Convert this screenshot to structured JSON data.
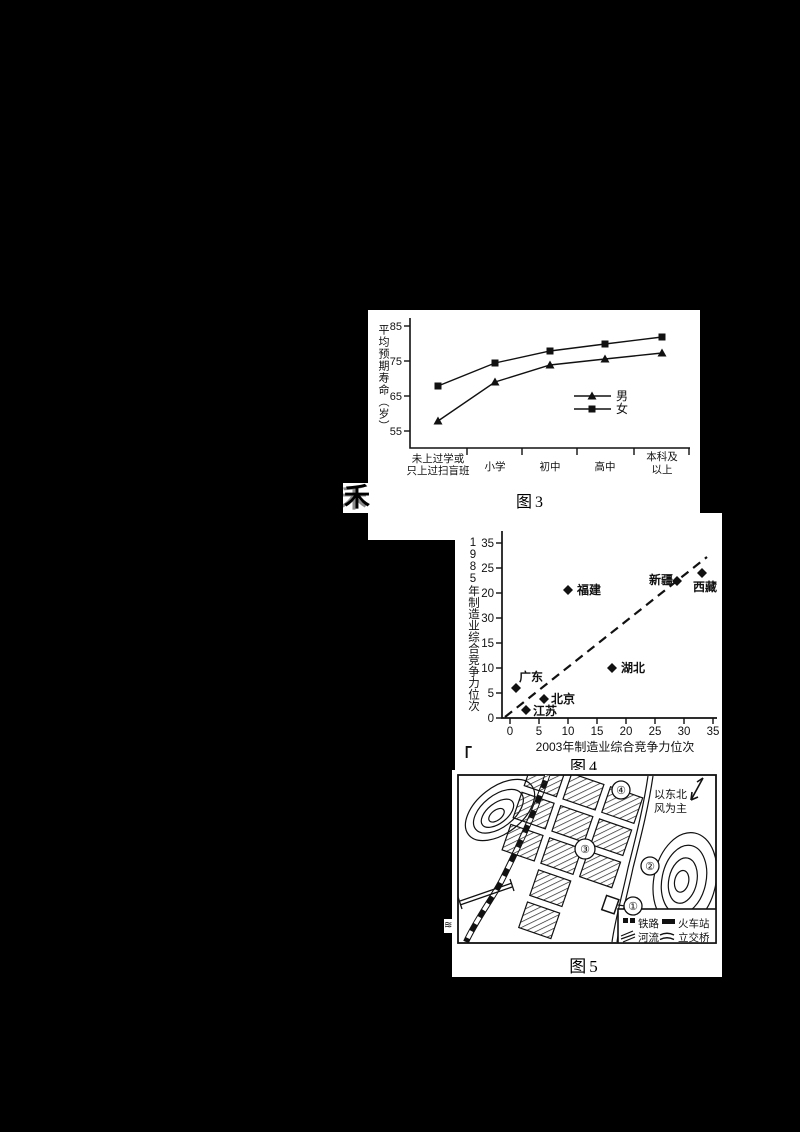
{
  "colors": {
    "page_bg": "#000000",
    "panel_bg": "#ffffff",
    "ink": "#111111"
  },
  "stray_marks": {
    "cut_character": "禾",
    "corner_bracket": "「",
    "edge_squiggle": "≋"
  },
  "chart_data": [
    {
      "id": "figure3",
      "type": "line",
      "title": "图3",
      "xlabel": "",
      "ylabel": "平均预期寿命（岁）",
      "categories": [
        "未上过学或只上过扫盲班",
        "小学",
        "初中",
        "高中",
        "本科及以上"
      ],
      "category_lines": [
        [
          "未上过学或",
          "只上过扫盲班"
        ],
        [
          "小学"
        ],
        [
          "初中"
        ],
        [
          "高中"
        ],
        [
          "本科及",
          "以上"
        ]
      ],
      "series": [
        {
          "name": "男",
          "marker": "triangle",
          "values": [
            58,
            69,
            74,
            75.5,
            78
          ]
        },
        {
          "name": "女",
          "marker": "square",
          "values": [
            68,
            74.5,
            78,
            80,
            82
          ]
        }
      ],
      "y_ticks": [
        85,
        75,
        65,
        55
      ],
      "ylim": [
        50,
        85
      ],
      "grid": false,
      "legend_position": "center-right"
    },
    {
      "id": "figure4",
      "type": "scatter",
      "title": "图4",
      "xlabel": "2003年制造业综合竞争力位次",
      "ylabel": "1985年制造业综合竞争力位次",
      "x_ticks": [
        0,
        5,
        10,
        15,
        20,
        25,
        30,
        35
      ],
      "y_tick_labels_as_printed": [
        35,
        25,
        20,
        30,
        15,
        10,
        5,
        0
      ],
      "xlim": [
        0,
        35
      ],
      "ylim": [
        0,
        35
      ],
      "points": [
        {
          "label": "广东",
          "x": 1,
          "y": 6
        },
        {
          "label": "江苏",
          "x": 3,
          "y": 2
        },
        {
          "label": "北京",
          "x": 6,
          "y": 4
        },
        {
          "label": "福建",
          "x": 10,
          "y": 25
        },
        {
          "label": "湖北",
          "x": 18,
          "y": 10
        },
        {
          "label": "新疆",
          "x": 29,
          "y": 27
        },
        {
          "label": "西藏",
          "x": 33,
          "y": 29
        }
      ],
      "trendline": {
        "style": "dashed",
        "from": [
          0,
          0
        ],
        "to": [
          35,
          32
        ]
      },
      "grid": false
    }
  ],
  "map5": {
    "caption": "图5",
    "wind_note_lines": [
      "以东北",
      "风为主"
    ],
    "numbered_markers": [
      "①",
      "②",
      "③",
      "④"
    ],
    "legend": {
      "railway": "铁路",
      "station": "火车站",
      "river": "河流",
      "overpass": "立交桥"
    }
  }
}
